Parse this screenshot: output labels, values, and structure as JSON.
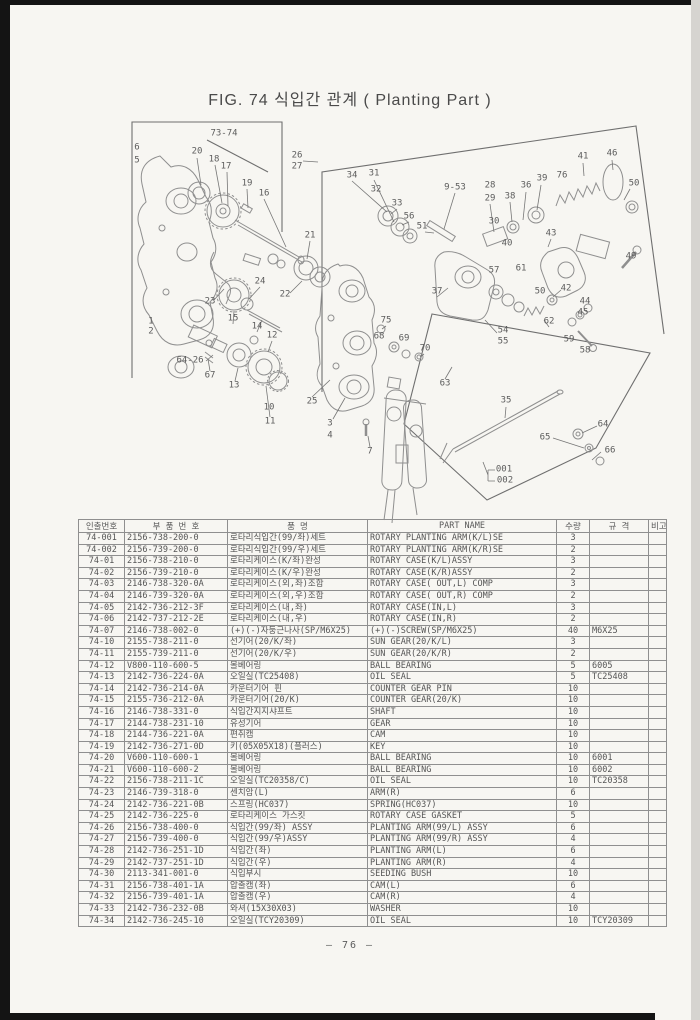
{
  "page": {
    "title": "FIG. 74 식입간 관계 ( Planting Part )",
    "page_number": "— 76 —"
  },
  "figure": {
    "callouts": [
      {
        "n": "73-74",
        "x": 224,
        "y": 134
      },
      {
        "n": "6",
        "x": 137,
        "y": 148
      },
      {
        "n": "5",
        "x": 137,
        "y": 161
      },
      {
        "n": "20",
        "x": 197,
        "y": 152
      },
      {
        "n": "18",
        "x": 214,
        "y": 160
      },
      {
        "n": "17",
        "x": 226,
        "y": 167
      },
      {
        "n": "19",
        "x": 247,
        "y": 184
      },
      {
        "n": "16",
        "x": 264,
        "y": 194
      },
      {
        "n": "26",
        "x": 297,
        "y": 156
      },
      {
        "n": "27",
        "x": 297,
        "y": 167
      },
      {
        "n": "34",
        "x": 352,
        "y": 176
      },
      {
        "n": "31",
        "x": 374,
        "y": 174
      },
      {
        "n": "32",
        "x": 376,
        "y": 190
      },
      {
        "n": "9-53",
        "x": 455,
        "y": 188
      },
      {
        "n": "28",
        "x": 490,
        "y": 186
      },
      {
        "n": "29",
        "x": 490,
        "y": 199
      },
      {
        "n": "38",
        "x": 510,
        "y": 197
      },
      {
        "n": "36",
        "x": 526,
        "y": 186
      },
      {
        "n": "39",
        "x": 542,
        "y": 179
      },
      {
        "n": "76",
        "x": 562,
        "y": 176
      },
      {
        "n": "41",
        "x": 583,
        "y": 157
      },
      {
        "n": "46",
        "x": 612,
        "y": 154
      },
      {
        "n": "50",
        "x": 634,
        "y": 184
      },
      {
        "n": "33",
        "x": 397,
        "y": 204
      },
      {
        "n": "56",
        "x": 409,
        "y": 217
      },
      {
        "n": "51",
        "x": 422,
        "y": 227
      },
      {
        "n": "30",
        "x": 494,
        "y": 222
      },
      {
        "n": "40",
        "x": 507,
        "y": 244
      },
      {
        "n": "43",
        "x": 551,
        "y": 234
      },
      {
        "n": "49",
        "x": 631,
        "y": 257
      },
      {
        "n": "57",
        "x": 494,
        "y": 271
      },
      {
        "n": "61",
        "x": 521,
        "y": 269
      },
      {
        "n": "37",
        "x": 437,
        "y": 292
      },
      {
        "n": "50",
        "x": 540,
        "y": 292
      },
      {
        "n": "42",
        "x": 566,
        "y": 289
      },
      {
        "n": "44",
        "x": 585,
        "y": 302
      },
      {
        "n": "45",
        "x": 583,
        "y": 313
      },
      {
        "n": "62",
        "x": 549,
        "y": 322
      },
      {
        "n": "54",
        "x": 503,
        "y": 331
      },
      {
        "n": "55",
        "x": 503,
        "y": 342
      },
      {
        "n": "59",
        "x": 569,
        "y": 340
      },
      {
        "n": "58",
        "x": 585,
        "y": 351
      },
      {
        "n": "21",
        "x": 310,
        "y": 236
      },
      {
        "n": "24",
        "x": 260,
        "y": 282
      },
      {
        "n": "22",
        "x": 285,
        "y": 295
      },
      {
        "n": "23",
        "x": 210,
        "y": 302
      },
      {
        "n": "1",
        "x": 151,
        "y": 322
      },
      {
        "n": "2",
        "x": 151,
        "y": 332
      },
      {
        "n": "15",
        "x": 233,
        "y": 319
      },
      {
        "n": "14",
        "x": 257,
        "y": 327
      },
      {
        "n": "12",
        "x": 272,
        "y": 336
      },
      {
        "n": "64-26",
        "x": 190,
        "y": 361
      },
      {
        "n": "67",
        "x": 210,
        "y": 376
      },
      {
        "n": "13",
        "x": 234,
        "y": 386
      },
      {
        "n": "10",
        "x": 269,
        "y": 408
      },
      {
        "n": "11",
        "x": 270,
        "y": 422
      },
      {
        "n": "25",
        "x": 312,
        "y": 402
      },
      {
        "n": "75",
        "x": 386,
        "y": 321
      },
      {
        "n": "68",
        "x": 379,
        "y": 337
      },
      {
        "n": "69",
        "x": 404,
        "y": 339
      },
      {
        "n": "70",
        "x": 425,
        "y": 349
      },
      {
        "n": "63",
        "x": 445,
        "y": 384
      },
      {
        "n": "35",
        "x": 506,
        "y": 401
      },
      {
        "n": "3",
        "x": 330,
        "y": 424
      },
      {
        "n": "4",
        "x": 330,
        "y": 436
      },
      {
        "n": "7",
        "x": 370,
        "y": 452
      },
      {
        "n": "64",
        "x": 603,
        "y": 425
      },
      {
        "n": "65",
        "x": 545,
        "y": 438
      },
      {
        "n": "66",
        "x": 610,
        "y": 451
      },
      {
        "n": "001",
        "x": 504,
        "y": 470
      },
      {
        "n": "002",
        "x": 505,
        "y": 481
      }
    ]
  },
  "table": {
    "headers": [
      "인출번호",
      "부 품 번 호",
      "품        명",
      "PART NAME",
      "수량",
      "규    격",
      "비고"
    ],
    "rows": [
      [
        "74-001",
        "2156-738-200-0",
        "로타리식입간(99/좌)세트",
        "ROTARY PLANTING ARM(K/L)SE",
        "3",
        "",
        ""
      ],
      [
        "74-002",
        "2156-739-200-0",
        "로타리식입간(99/우)세트",
        "ROTARY PLANTING ARM(K/R)SE",
        "2",
        "",
        ""
      ],
      [
        "74-01",
        "2156-738-210-0",
        "로타리케이스(K/좌)완성",
        "ROTARY CASE(K/L)ASSY",
        "3",
        "",
        ""
      ],
      [
        "74-02",
        "2156-739-210-0",
        "로타리케이스(K/우)완성",
        "ROTARY CASE(K/R)ASSY",
        "2",
        "",
        ""
      ],
      [
        "74-03",
        "2146-738-320-0A",
        "로타리케이스(외,좌)조합",
        "ROTARY CASE( OUT,L) COMP",
        "3",
        "",
        ""
      ],
      [
        "74-04",
        "2146-739-320-0A",
        "로타리케이스(외,우)조합",
        "ROTARY CASE( OUT,R) COMP",
        "2",
        "",
        ""
      ],
      [
        "74-05",
        "2142-736-212-3F",
        "로타리케이스(내,좌)",
        "ROTARY CASE(IN,L)",
        "3",
        "",
        ""
      ],
      [
        "74-06",
        "2142-737-212-2E",
        "로타리케이스(내,우)",
        "ROTARY CASE(IN,R)",
        "2",
        "",
        ""
      ],
      [
        "74-07",
        "2146-738-002-0",
        "(+)(-)자둥근나사(SP/M6X25)",
        "(+)(-)SCREW(SP/M6X25)",
        "40",
        "M6X25",
        ""
      ],
      [
        "74-10",
        "2155-738-211-0",
        "선기어(20/K/좌)",
        "SUN GEAR(20/K/L)",
        "3",
        "",
        ""
      ],
      [
        "74-11",
        "2155-739-211-0",
        "선기어(20/K/우)",
        "SUN GEAR(20/K/R)",
        "2",
        "",
        ""
      ],
      [
        "74-12",
        "V800-110-600-5",
        "볼베어링",
        "BALL BEARING",
        "5",
        "6005",
        ""
      ],
      [
        "74-13",
        "2142-736-224-0A",
        "오일실(TC25408)",
        "OIL SEAL",
        "5",
        "TC25408",
        ""
      ],
      [
        "74-14",
        "2142-736-214-0A",
        "카운터기어 핀",
        "COUNTER GEAR PIN",
        "10",
        "",
        ""
      ],
      [
        "74-15",
        "2155-736-212-0A",
        "카운터기어(20/K)",
        "COUNTER GEAR(20/K)",
        "10",
        "",
        ""
      ],
      [
        "74-16",
        "2146-738-331-0",
        "식입간지지샤프트",
        "SHAFT",
        "10",
        "",
        ""
      ],
      [
        "74-17",
        "2144-738-231-10",
        "유성기어",
        "GEAR",
        "10",
        "",
        ""
      ],
      [
        "74-18",
        "2144-736-221-0A",
        "편취캠",
        "CAM",
        "10",
        "",
        ""
      ],
      [
        "74-19",
        "2142-736-271-0D",
        "키(05X05X18)(플러스)",
        "KEY",
        "10",
        "",
        ""
      ],
      [
        "74-20",
        "V600-110-600-1",
        "볼베어링",
        "BALL BEARING",
        "10",
        "6001",
        ""
      ],
      [
        "74-21",
        "V600-110-600-2",
        "볼베어링",
        "BALL BEARING",
        "10",
        "6002",
        ""
      ],
      [
        "74-22",
        "2156-738-211-1C",
        "오일실(TC20358/C)",
        "OIL SEAL",
        "10",
        "TC20358",
        ""
      ],
      [
        "74-23",
        "2146-739-318-0",
        "센치암(L)",
        "ARM(R)",
        "6",
        "",
        ""
      ],
      [
        "74-24",
        "2142-736-221-0B",
        "스프링(HC037)",
        "SPRING(HC037)",
        "10",
        "",
        ""
      ],
      [
        "74-25",
        "2142-736-225-0",
        "로타리케이스 가스킷",
        "ROTARY CASE GASKET",
        "5",
        "",
        ""
      ],
      [
        "74-26",
        "2156-738-400-0",
        "식입간(99/좌) ASSY",
        "PLANTING ARM(99/L) ASSY",
        "6",
        "",
        ""
      ],
      [
        "74-27",
        "2156-739-400-0",
        "식입간(99/우)ASSY",
        "PLANTING ARM(99/R) ASSY",
        "4",
        "",
        ""
      ],
      [
        "74-28",
        "2142-736-251-1D",
        "식입간(좌)",
        "PLANTING ARM(L)",
        "6",
        "",
        ""
      ],
      [
        "74-29",
        "2142-737-251-1D",
        "식입간(우)",
        "PLANTING ARM(R)",
        "4",
        "",
        ""
      ],
      [
        "74-30",
        "2113-341-001-0",
        "식입부시",
        "SEEDING BUSH",
        "10",
        "",
        ""
      ],
      [
        "74-31",
        "2156-738-401-1A",
        "압출캠(좌)",
        "CAM(L)",
        "6",
        "",
        ""
      ],
      [
        "74-32",
        "2156-739-401-1A",
        "압출캠(우)",
        "CAM(R)",
        "4",
        "",
        ""
      ],
      [
        "74-33",
        "2142-736-232-0B",
        "와셔(15X30X03)",
        "WASHER",
        "10",
        "",
        ""
      ],
      [
        "74-34",
        "2142-736-245-10",
        "오일실(TCY20309)",
        "OIL SEAL",
        "10",
        "TCY20309",
        ""
      ]
    ]
  }
}
